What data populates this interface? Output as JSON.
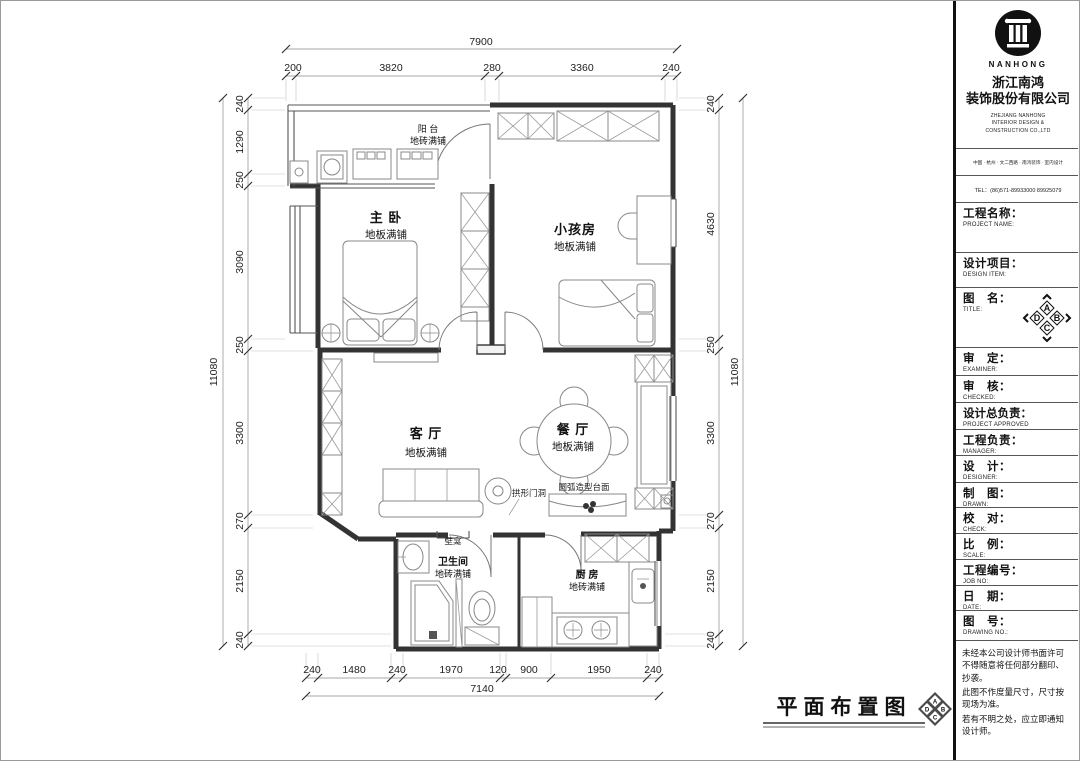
{
  "plan": {
    "drawing_title": "平面布置图",
    "rooms": {
      "balcony": {
        "name": "阳 台",
        "finish": "地砖满铺"
      },
      "master": {
        "name": "主 卧",
        "finish": "地板满铺"
      },
      "kids": {
        "name": "小孩房",
        "finish": "地板满铺"
      },
      "living": {
        "name": "客 厅",
        "finish": "地板满铺"
      },
      "dining": {
        "name": "餐 厅",
        "finish": "地板满铺"
      },
      "bath": {
        "name": "卫生间",
        "finish": "地砖满铺"
      },
      "kitchen": {
        "name": "厨 房",
        "finish": "地砖满铺"
      }
    },
    "annotations": {
      "arch_opening": "拱形门洞",
      "curved_counter": "圆弧造型台面",
      "niche": "壁龛"
    },
    "dims": {
      "top": {
        "overall": "7900",
        "segments": [
          "200",
          "3820",
          "280",
          "3360",
          "240"
        ]
      },
      "left": {
        "overall": "11080",
        "segments": [
          "240",
          "1290",
          "250",
          "3090",
          "250",
          "3300",
          "270",
          "2150",
          "240"
        ]
      },
      "right": {
        "overall": "11080",
        "segments": [
          "240",
          "4630",
          "250",
          "3300",
          "270",
          "2150",
          "240"
        ]
      },
      "bottom": {
        "overall": "7140",
        "segments": [
          "240",
          "1480",
          "240",
          "1970",
          "120",
          "900",
          "1950",
          "240"
        ]
      }
    }
  },
  "company": {
    "logo_text": "NANHONG",
    "name_cn_1": "浙江南鸿",
    "name_cn_2": "装饰股份有限公司",
    "name_en_1": "ZHEJIANG NANHONG",
    "name_en_2": "INTERIOR DESIGN &",
    "name_en_3": "CONSTRUCTION CO.,LTD",
    "address": "中国 · 杭州 · 文二西路 · 南鸿装饰 · 室内设计",
    "tel": "TEL：(86)571-89933000  89925079"
  },
  "titleblock": {
    "rows": [
      {
        "cn": "工程名称：",
        "en": "PROJECT NAME:"
      },
      {
        "cn": "设计项目：",
        "en": "DESIGN ITEM:"
      },
      {
        "cn": "图　名：",
        "en": "TITLE:"
      },
      {
        "cn": "审　定：",
        "en": "EXAMINER:"
      },
      {
        "cn": "审　核：",
        "en": "CHECKED:"
      },
      {
        "cn": "设计总负责：",
        "en": "PROJECT APPROVED"
      },
      {
        "cn": "工程负责：",
        "en": "MANAGER:"
      },
      {
        "cn": "设　计：",
        "en": "DESIGNER:"
      },
      {
        "cn": "制　图：",
        "en": "DRAWN:"
      },
      {
        "cn": "校　对：",
        "en": "CHECK:"
      },
      {
        "cn": "比　例：",
        "en": "SCALE:"
      },
      {
        "cn": "工程编号：",
        "en": "JOB NO:"
      },
      {
        "cn": "日　期：",
        "en": "DATE:"
      },
      {
        "cn": "图　号：",
        "en": "DRAWING NO.:"
      }
    ],
    "orientation": {
      "top": "A",
      "right": "B",
      "bottom": "C",
      "left": "D"
    },
    "notes": [
      "未经本公司设计师书面许可不得随意将任何部分翻印、抄袭。",
      "此图不作度量尺寸，尺寸按现场为准。",
      "若有不明之处，应立即通知设计师。"
    ]
  }
}
